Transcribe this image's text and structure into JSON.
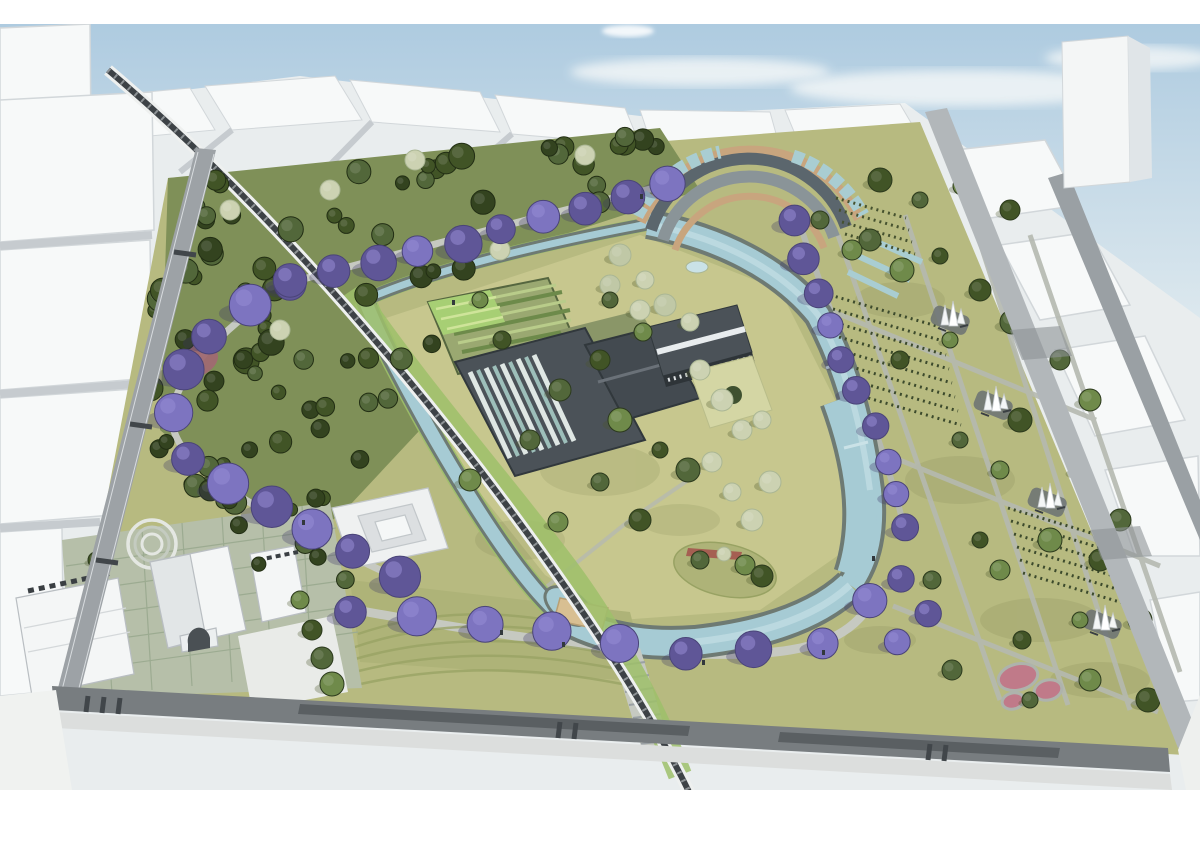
{
  "meta": {
    "title": "Aerial architectural rendering of an urban park master plan",
    "description": "Bird's-eye rendering of a park surrounded by white city massing: a looping light-blue canal encircles central lawns and industrial halls, a diagonal elevated railway crosses the site, arcs of purple jacaranda trees line the promenades, a curved terraced pavilion sits at the top, heritage buildings and a paved plaza occupy the lower left, and lawns with path grids, white spire sculptures and pink circular pools fill the right section."
  },
  "scene": {
    "elements": [
      "sky-with-clouds",
      "white-city-blocks",
      "tall-tower",
      "railway-viaduct",
      "canal-loop",
      "dense-forest",
      "jacaranda-rows",
      "curved-terrace-pavilion",
      "industrial-hall",
      "colonnade-building",
      "garden-allotments",
      "central-lawns",
      "island-with-red-structure",
      "grand-stair",
      "lawn-terraces",
      "heritage-buildings",
      "paved-plaza",
      "path-grid",
      "spire-sculptures",
      "pink-pools",
      "perimeter-roads"
    ]
  },
  "palette": {
    "paper": "#ffffff",
    "skyTop": "#aecbe0",
    "skyLow": "#dce8ee",
    "cloud": "#f2f6f7",
    "cityBase": "#e9edee",
    "roof": "#f7f9f9",
    "roofShade": "#e0e5e8",
    "blockEdge": "#d2d7da",
    "street": "#c6cbcf",
    "streetDark": "#9aa0a4",
    "roadMain": "#787d80",
    "roadLane": "#5a5f62",
    "roadLeft": "#9da2a6",
    "roadRight": "#b2b7ba",
    "sidewalk": "#dcdedd",
    "crossTick": "#41464a",
    "parkBase": "#b7ba80",
    "lawnLight": "#c7c78e",
    "lawnMid": "#aeb378",
    "lawnDark": "#98a263",
    "forestFloor": "#7f9058",
    "mottle": "#6b7440",
    "treeDark": "#33431f",
    "treeDark2": "#415426",
    "treeMid": "#52673a",
    "treeLight": "#6f8a4a",
    "treePale": "#ccd2b2",
    "treePaleEdge": "#aab694",
    "jac": "#7d74c0",
    "jacDark": "#5f5697",
    "jacLight": "#968cd3",
    "waterEdge": "#6e7a73",
    "water": "#a6cbd4",
    "waterLight": "#cae2e7",
    "bank": "#9ec06a",
    "railWhite": "#eef0ef",
    "railDark": "#3d4246",
    "railTie": "#8d9295",
    "roofDarkBld": "#4b5258",
    "roofDarker": "#31383c",
    "stripeA": "#dfe7e4",
    "stripeB": "#9dbfba",
    "wood": "#c8a57e",
    "terraceDark": "#5b666d",
    "terraceMid": "#8a9498",
    "glass": "#a9cdd2",
    "whiteBld": "#f4f6f6",
    "plaza": "#b6bfa9",
    "plazaLine": "#9cab91",
    "plazaWhite": "#e9ebe8",
    "mauve": "#a06a72",
    "pink": "#c07a89",
    "tan": "#d8bf92",
    "islandRed": "#a55f52",
    "pathLight": "#c6c9c1",
    "pathMid": "#b5b9b0",
    "sculptPad": "#6b7173",
    "shadow": "#4c552c",
    "people": "#32383c"
  }
}
